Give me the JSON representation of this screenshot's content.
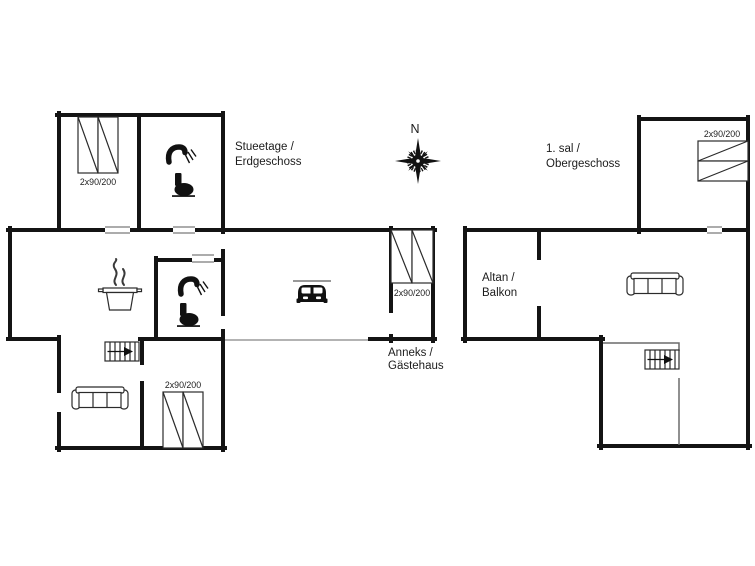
{
  "compass": {
    "north_label": "N"
  },
  "ground_floor": {
    "title_line1": "Stueetage /",
    "title_line2": "Erdgeschoss",
    "bed_nw_label": "2x90/200",
    "bed_s_label": "2x90/200"
  },
  "annex": {
    "label_line1": "Anneks /",
    "label_line2": "Gästehaus",
    "bed_label": "2x90/200"
  },
  "upper_floor": {
    "title_line1": "1. sal /",
    "title_line2": "Obergeschoss",
    "bed_label": "2x90/200",
    "balcony_line1": "Altan /",
    "balcony_line2": "Balkon"
  },
  "icons": {
    "compass": "compass-rose-icon",
    "bed": "double-bed-icon",
    "sofa": "sofa-icon",
    "stairs": "stairs-icon",
    "shower": "shower-icon",
    "toilet": "toilet-icon",
    "cooking": "pot-steam-icon",
    "car": "car-icon"
  },
  "colors": {
    "wall": "#141414",
    "furniture_line": "#2b2b2b",
    "thin_guide": "#9a9a9a",
    "background": "#ffffff"
  }
}
